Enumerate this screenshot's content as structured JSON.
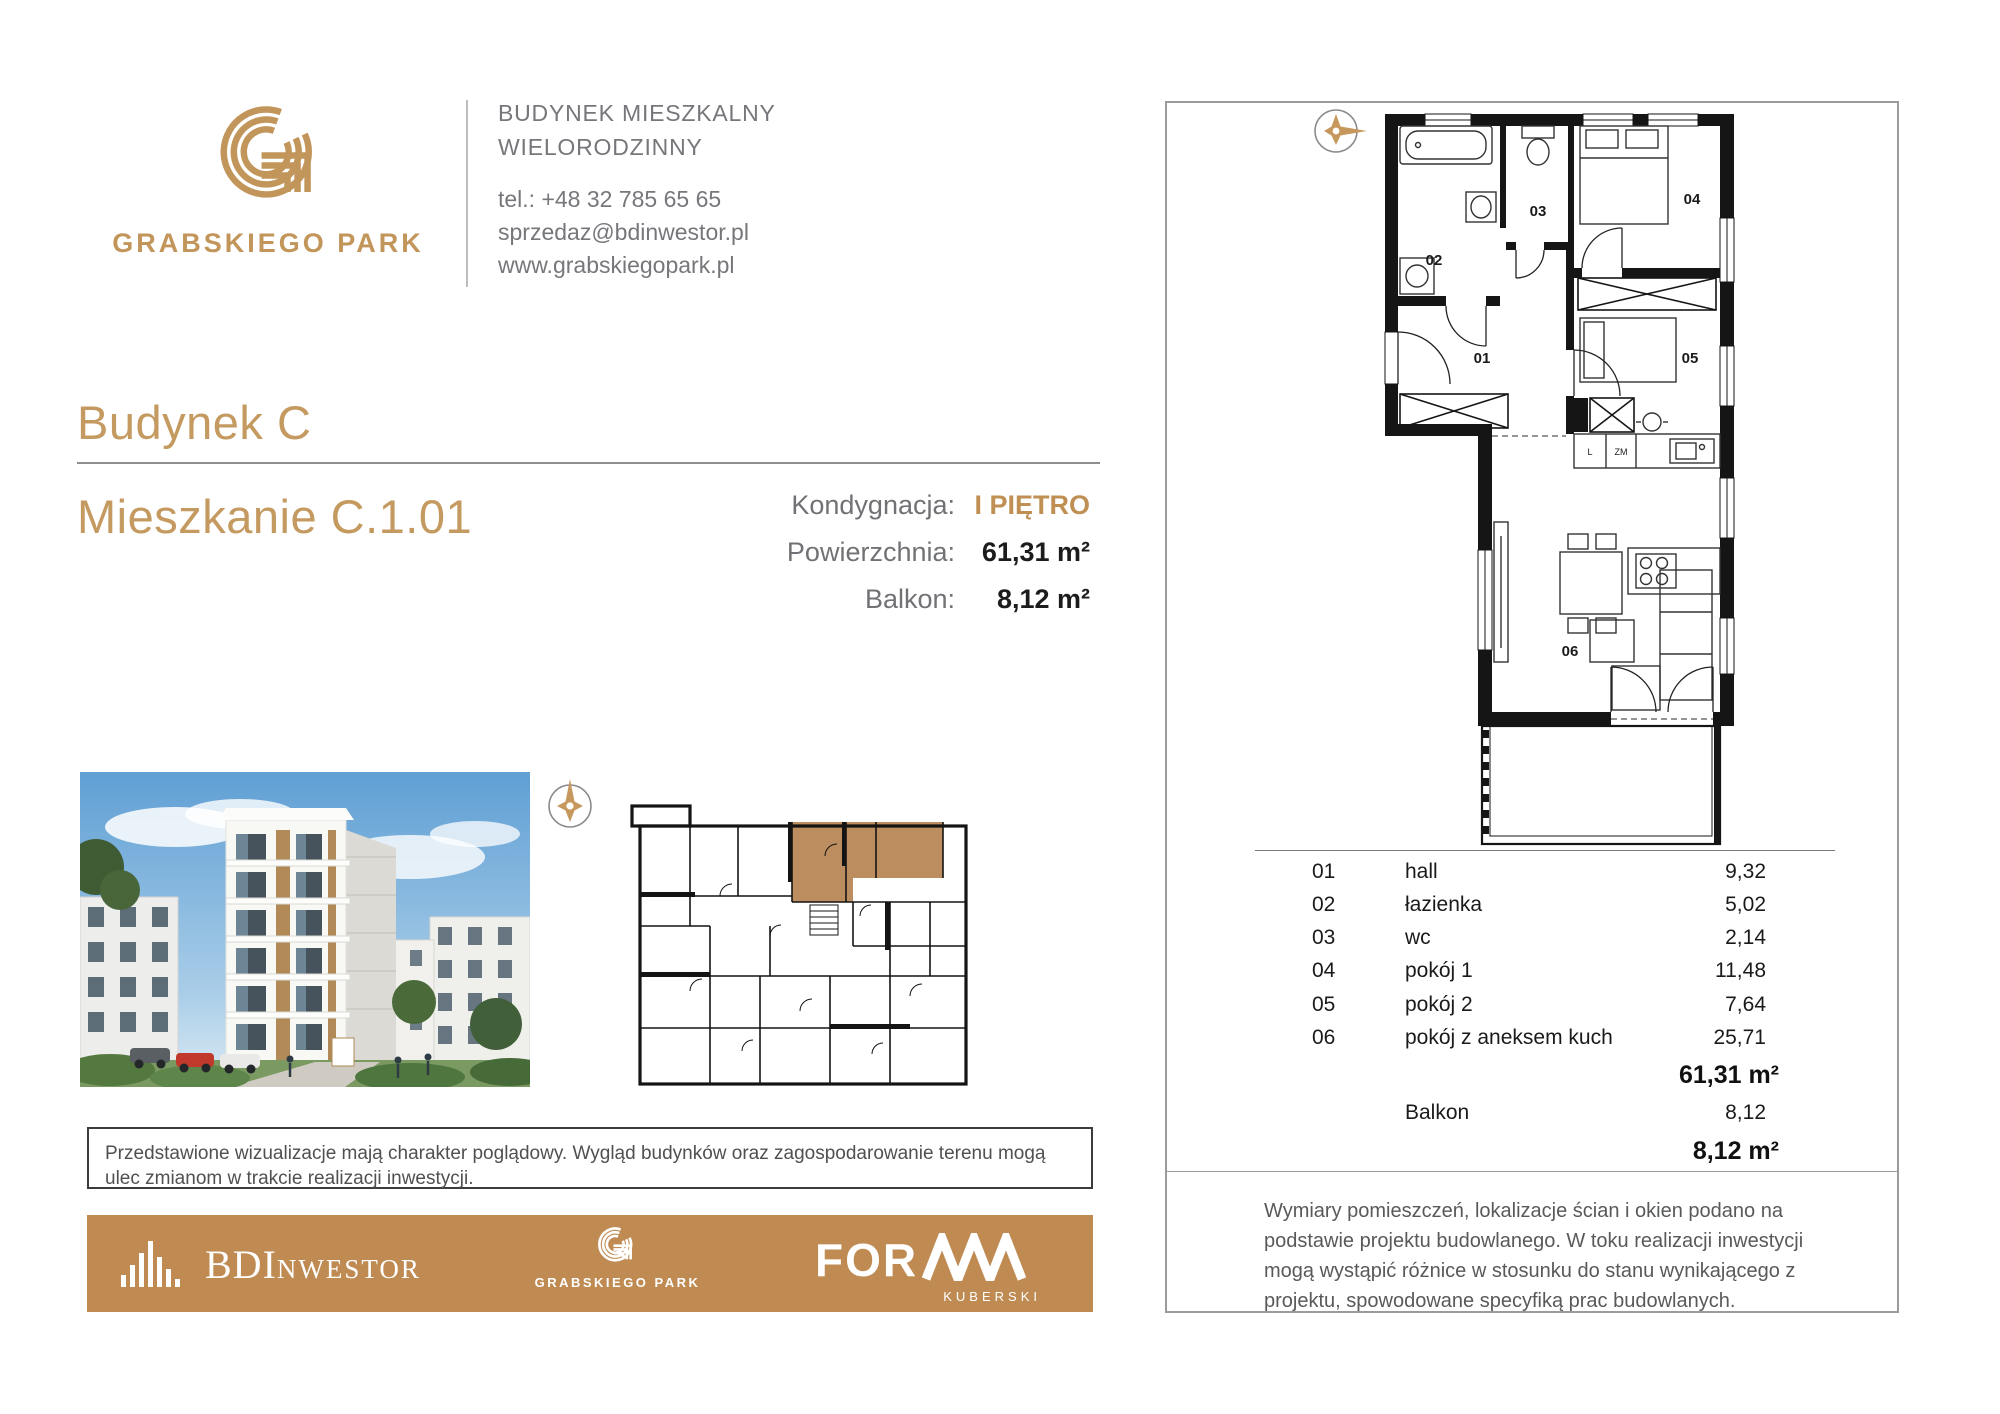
{
  "header": {
    "brand": "GRABSKIEGO PARK",
    "building_type_line1": "BUDYNEK MIESZKALNY",
    "building_type_line2": "WIELORODZINNY",
    "phone": "tel.: +48 32 785 65 65",
    "email": "sprzedaz@bdinwestor.pl",
    "website": "www.grabskiegopark.pl"
  },
  "title": {
    "building": "Budynek C",
    "apartment": "Mieszkanie C.1.01"
  },
  "details": {
    "floor_label": "Kondygnacja:",
    "floor_value": "I PIĘTRO",
    "area_label": "Powierzchnia:",
    "area_value": "61,31 m²",
    "balcony_label": "Balkon:",
    "balcony_value": "8,12 m²"
  },
  "left_section": {
    "disclaimer": "Przedstawione wizualizacje mają charakter poglądowy. Wygląd budynków oraz zagospodarowanie terenu mogą ulec zmianom w trakcie realizacji inwestycji."
  },
  "footer_logos": {
    "bdi_main": "BDI",
    "bdi_rest": "NWESTOR",
    "grabskiego": "GRABSKIEGO PARK",
    "forma": "FOR",
    "forma_sub": "KUBERSKI"
  },
  "right_panel": {
    "plan_labels": {
      "r01": "01",
      "r02": "02",
      "r03": "03",
      "r04": "04",
      "r05": "05",
      "r06": "06",
      "l": "L",
      "zm": "ZM"
    },
    "rooms": [
      {
        "id": "01",
        "name": "hall",
        "area": "9,32"
      },
      {
        "id": "02",
        "name": "łazienka",
        "area": "5,02"
      },
      {
        "id": "03",
        "name": "wc",
        "area": "2,14"
      },
      {
        "id": "04",
        "name": "pokój 1",
        "area": "11,48"
      },
      {
        "id": "05",
        "name": "pokój 2",
        "area": "7,64"
      },
      {
        "id": "06",
        "name": "pokój z aneksem kuch",
        "area": "25,71"
      }
    ],
    "total_area": "61,31 m²",
    "balcony_row_label": "Balkon",
    "balcony_row_area": "8,12",
    "balcony_total": "8,12 m²",
    "disclaimer": "Wymiary pomieszczeń, lokalizacje ścian i okien podano na podstawie projektu budowlanego. W toku realizacji inwestycji mogą wystąpić różnice w stosunku do stanu wynikającego z projektu, spowodowane specyfiką prac budowlanych."
  },
  "colors": {
    "gold": "#c2955a",
    "bar_gold": "#bf8b52",
    "apartment_highlight": "#bc8d5e",
    "gray_text": "#76777b"
  }
}
